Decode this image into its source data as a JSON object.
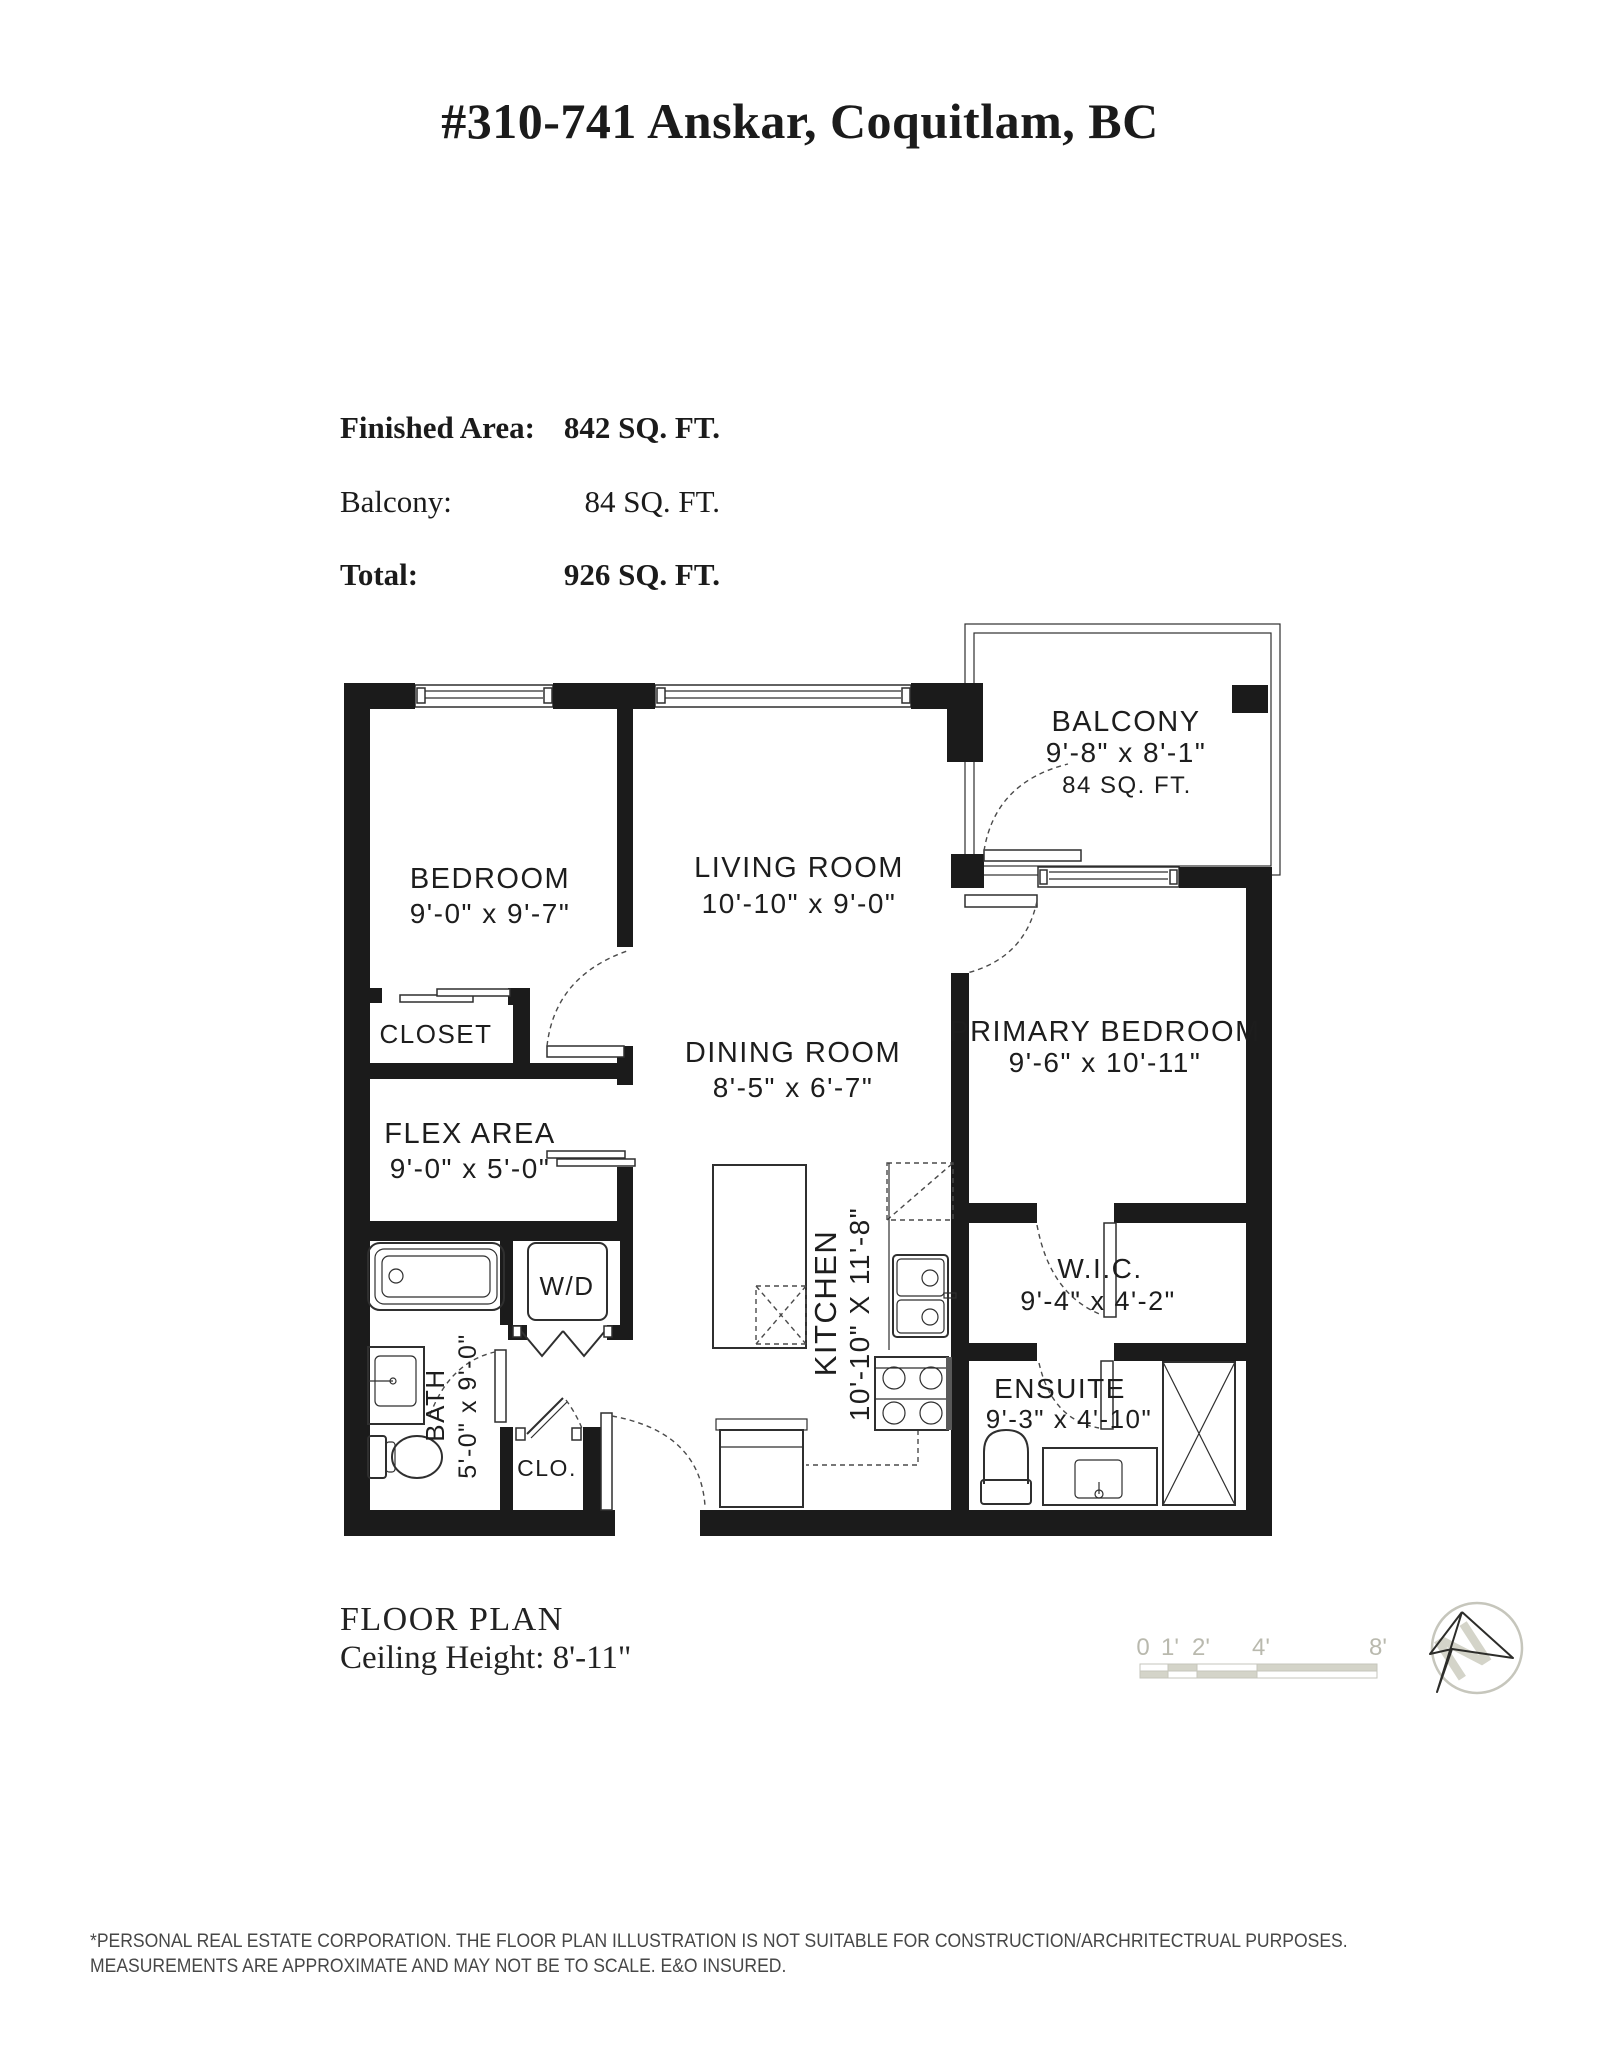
{
  "header": {
    "title": "#310-741 Anskar, Coquitlam, BC"
  },
  "summary": {
    "rows": [
      {
        "label": "Finished Area:",
        "value": "842 SQ. FT."
      },
      {
        "label": "Balcony:",
        "value": "84 SQ. FT."
      },
      {
        "label": "Total:",
        "value": "926 SQ. FT."
      }
    ]
  },
  "rooms": {
    "bedroom": {
      "name": "BEDROOM",
      "dims": "9'-0\" x 9'-7\""
    },
    "living": {
      "name": "LIVING ROOM",
      "dims": "10'-10\" x 9'-0\""
    },
    "balcony": {
      "name": "BALCONY",
      "dims": "9'-8\" x 8'-1\"",
      "area": "84 SQ. FT."
    },
    "primary": {
      "name": "PRIMARY BEDROOM",
      "dims": "9'-6\" x 10'-11\""
    },
    "dining": {
      "name": "DINING ROOM",
      "dims": "8'-5\" x 6'-7\""
    },
    "closet": {
      "name": "CLOSET"
    },
    "flex": {
      "name": "FLEX AREA",
      "dims": "9'-0\" x 5'-0\""
    },
    "kitchen": {
      "name": "KITCHEN",
      "dims": "10'-10\" X 11'-8\""
    },
    "bath": {
      "name": "BATH",
      "dims": "5'-0\" x 9'-0\""
    },
    "wd": {
      "name": "W/D"
    },
    "clo": {
      "name": "CLO."
    },
    "wic": {
      "name": "W.I.C.",
      "dims": "9'-4\" x 4'-2\""
    },
    "ensuite": {
      "name": "ENSUITE",
      "dims": "9'-3\" x 4'-10\""
    }
  },
  "footer": {
    "plan_label": "FLOOR PLAN",
    "ceiling_label": "Ceiling Height: 8'-11\""
  },
  "scale_bar": {
    "labels": [
      "0",
      "1'",
      "2'",
      "4'",
      "8'"
    ]
  },
  "compass": {
    "letter": "N"
  },
  "disclaimer": {
    "line1": "*PERSONAL REAL ESTATE CORPORATION. THE FLOOR PLAN ILLUSTRATION IS NOT SUITABLE FOR CONSTRUCTION/ARCHRITECTRUAL PURPOSES.",
    "line2": "MEASUREMENTS ARE APPROXIMATE AND MAY NOT BE TO SCALE. E&O INSURED."
  },
  "colors": {
    "wall": "#1b1b1b",
    "line": "#2f2f2f",
    "dash": "#4a4a4a",
    "muted": "#b9b9ae",
    "scale_fill": "#d4d4c9",
    "scale_line": "#c6c6bc",
    "text": "#1b1b1b",
    "disclaimer_text": "#474747"
  }
}
